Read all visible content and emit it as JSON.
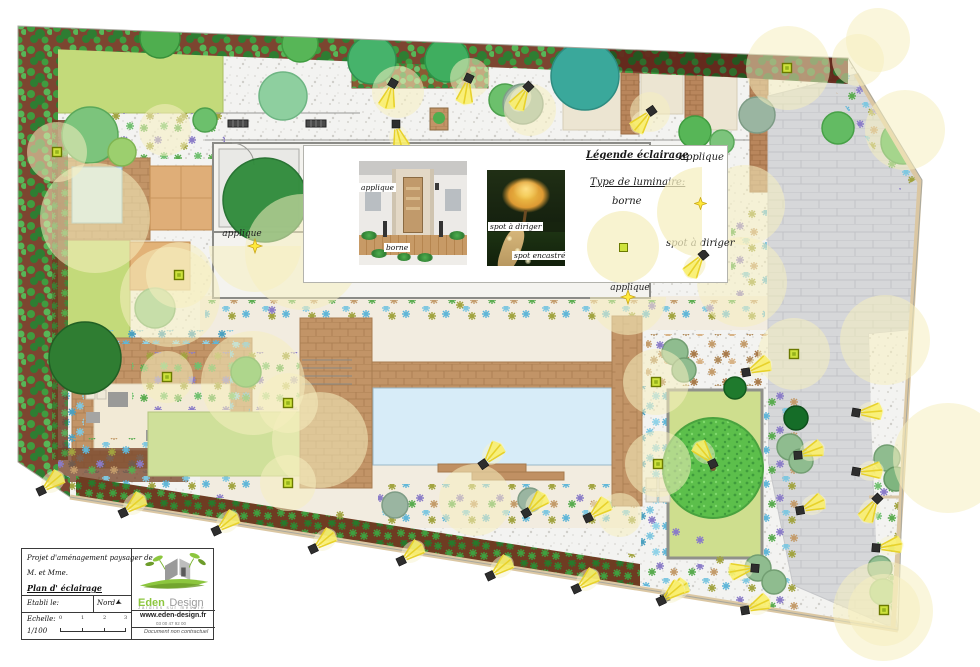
{
  "plan": {
    "labels": [
      {
        "text": "applique",
        "x": 242,
        "y": 236
      },
      {
        "text": "applique",
        "x": 630,
        "y": 290
      }
    ]
  },
  "legend": {
    "title": "Légende éclairage",
    "type_label": "Type de luminaire:",
    "applique_label": "applique",
    "borne_label": "borne",
    "spot_label": "spot à diriger",
    "photo_entrance": {
      "applique": "applique",
      "borne": "borne"
    },
    "photo_night": {
      "spot_direct": "spot à diriger",
      "spot_recessed": "spot encastré"
    }
  },
  "title_block": {
    "project_line1": "Projet d'aménagement paysager de",
    "project_line2": "M. et Mme.",
    "plan_title": "Plan d' éclairage",
    "established_label": "Etabli le:",
    "north_label": "Nord",
    "scale_label": "Echelle:",
    "scale_value": "1/100",
    "scale_ticks": [
      "0",
      "1",
      "2",
      "3"
    ],
    "company_name_1": "Eden",
    "company_name_2": "Design",
    "tagline": "Jardins sur mesure",
    "website": "www.eden-design.fr",
    "phone": "03 00 47 92 00",
    "disclaimer": "Document non contractuel"
  },
  "lights": {
    "halos": [
      {
        "x": 95,
        "y": 218,
        "r": 55
      },
      {
        "x": 165,
        "y": 130,
        "r": 26
      },
      {
        "x": 170,
        "y": 297,
        "r": 50
      },
      {
        "x": 253,
        "y": 383,
        "r": 52
      },
      {
        "x": 320,
        "y": 440,
        "r": 48
      },
      {
        "x": 475,
        "y": 500,
        "r": 36
      },
      {
        "x": 530,
        "y": 110,
        "r": 26
      },
      {
        "x": 398,
        "y": 92,
        "r": 26
      },
      {
        "x": 470,
        "y": 78,
        "r": 20
      },
      {
        "x": 650,
        "y": 112,
        "r": 20
      },
      {
        "x": 788,
        "y": 68,
        "r": 42
      },
      {
        "x": 858,
        "y": 60,
        "r": 26
      },
      {
        "x": 905,
        "y": 130,
        "r": 40
      },
      {
        "x": 878,
        "y": 40,
        "r": 32
      },
      {
        "x": 745,
        "y": 205,
        "r": 40
      },
      {
        "x": 742,
        "y": 282,
        "r": 45
      },
      {
        "x": 885,
        "y": 340,
        "r": 45
      },
      {
        "x": 948,
        "y": 458,
        "r": 55
      },
      {
        "x": 883,
        "y": 611,
        "r": 50
      },
      {
        "x": 620,
        "y": 515,
        "r": 22
      },
      {
        "x": 303,
        "y": 252,
        "r": 58
      }
    ],
    "bornes": [
      {
        "x": 57,
        "y": 152,
        "h": 30
      },
      {
        "x": 179,
        "y": 275,
        "h": 33
      },
      {
        "x": 167,
        "y": 377,
        "h": 26
      },
      {
        "x": 288,
        "y": 403,
        "h": 30
      },
      {
        "x": 288,
        "y": 483,
        "h": 28
      },
      {
        "x": 656,
        "y": 382,
        "h": 33
      },
      {
        "x": 658,
        "y": 464,
        "h": 33
      },
      {
        "x": 794,
        "y": 354,
        "h": 36
      },
      {
        "x": 787,
        "y": 68,
        "h": 0
      },
      {
        "x": 884,
        "y": 610,
        "h": 36
      }
    ],
    "appliques": [
      {
        "x": 255,
        "y": 246,
        "rot": 90,
        "r": 46
      },
      {
        "x": 628,
        "y": 297,
        "rot": 90,
        "r": 38
      }
    ],
    "spots": [
      {
        "x": 392,
        "y": 85,
        "rot": 105
      },
      {
        "x": 468,
        "y": 80,
        "rot": 100
      },
      {
        "x": 527,
        "y": 88,
        "rot": 120
      },
      {
        "x": 396,
        "y": 126,
        "rot": 75
      },
      {
        "x": 650,
        "y": 112,
        "rot": 130
      },
      {
        "x": 485,
        "y": 463,
        "rot": -50
      },
      {
        "x": 528,
        "y": 512,
        "rot": -45
      },
      {
        "x": 590,
        "y": 517,
        "rot": -40
      },
      {
        "x": 748,
        "y": 372,
        "rot": -25
      },
      {
        "x": 800,
        "y": 455,
        "rot": -20
      },
      {
        "x": 802,
        "y": 510,
        "rot": -25
      },
      {
        "x": 753,
        "y": 568,
        "rot": 170
      },
      {
        "x": 667,
        "y": 597,
        "rot": -35
      },
      {
        "x": 747,
        "y": 610,
        "rot": -25
      },
      {
        "x": 712,
        "y": 462,
        "rot": -130
      },
      {
        "x": 43,
        "y": 490,
        "rot": -40
      },
      {
        "x": 125,
        "y": 512,
        "rot": -40
      },
      {
        "x": 218,
        "y": 530,
        "rot": -40
      },
      {
        "x": 315,
        "y": 548,
        "rot": -40
      },
      {
        "x": 403,
        "y": 560,
        "rot": -40
      },
      {
        "x": 492,
        "y": 575,
        "rot": -40
      },
      {
        "x": 578,
        "y": 588,
        "rot": -40
      },
      {
        "x": 663,
        "y": 600,
        "rot": -40
      },
      {
        "x": 858,
        "y": 413,
        "rot": -5
      },
      {
        "x": 858,
        "y": 472,
        "rot": -5
      },
      {
        "x": 876,
        "y": 500,
        "rot": 120
      },
      {
        "x": 878,
        "y": 548,
        "rot": -10
      }
    ]
  },
  "colors": {
    "halo": "#f5efc0",
    "borne_fill": "#cde23c",
    "borne_edge": "#6b7a00",
    "beam": "#f6e93d",
    "star": "#ffe93c",
    "lawn": "#c3da7a",
    "lawn_light": "#cfe09a",
    "pool": "#d7ecf8",
    "wood": "#c29467",
    "paving": "#d6d7d9",
    "terracotta": "#dfae78",
    "hedge_soil": "#7c4530",
    "cream": "#f2ece0",
    "logo_green": "#8cc63e"
  }
}
